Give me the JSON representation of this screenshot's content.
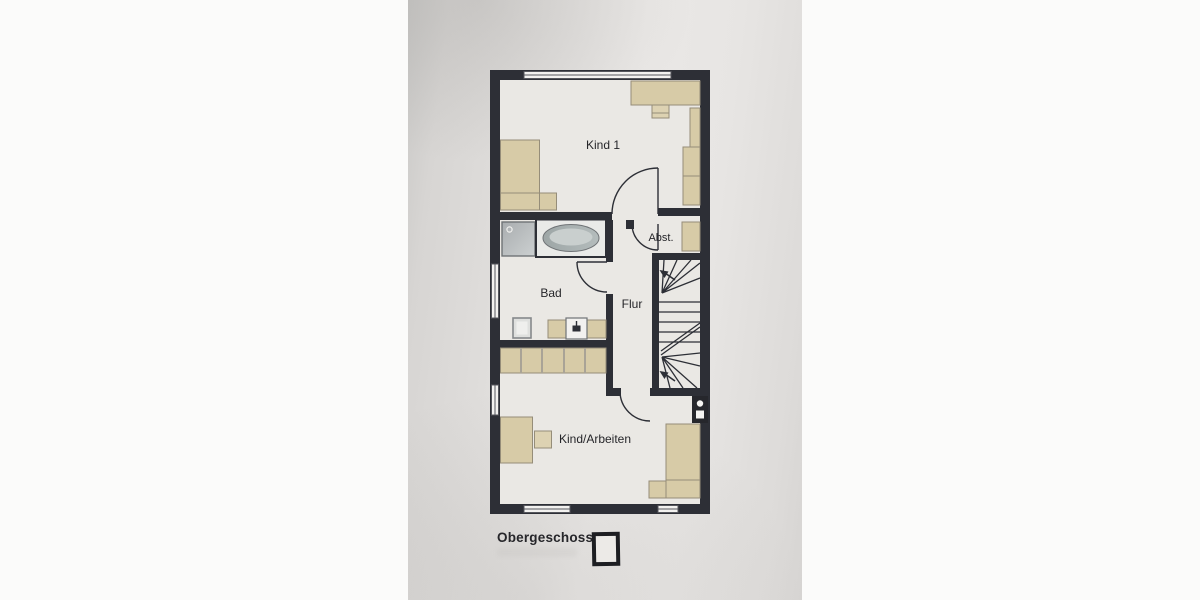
{
  "floor": {
    "label": "Obergeschoss"
  },
  "rooms": {
    "kind1": "Kind 1",
    "bad": "Bad",
    "flur": "Flur",
    "abst": "Abst.",
    "kind_arbeiten": "Kind/Arbeiten"
  },
  "fixtures": [
    "bed",
    "nightstand",
    "desk",
    "chair",
    "shelf",
    "wardrobe",
    "shower",
    "bathtub",
    "toilet",
    "sink-vanity",
    "staircase",
    "stairs-up-arrow",
    "chimney-shaft",
    "window",
    "door-swing",
    "floor-plan-icon"
  ],
  "colors": {
    "wall": "#2d2f36",
    "plan_paper": "#eae8e4",
    "furniture": "#d7cba7",
    "furniture_border": "#958d79",
    "shower_gray": "#b6babc",
    "tub_gray": "#aab2b2",
    "photo_gray": "#dcdad8",
    "page_white": "#fbfbfa",
    "text": "#26262a"
  }
}
